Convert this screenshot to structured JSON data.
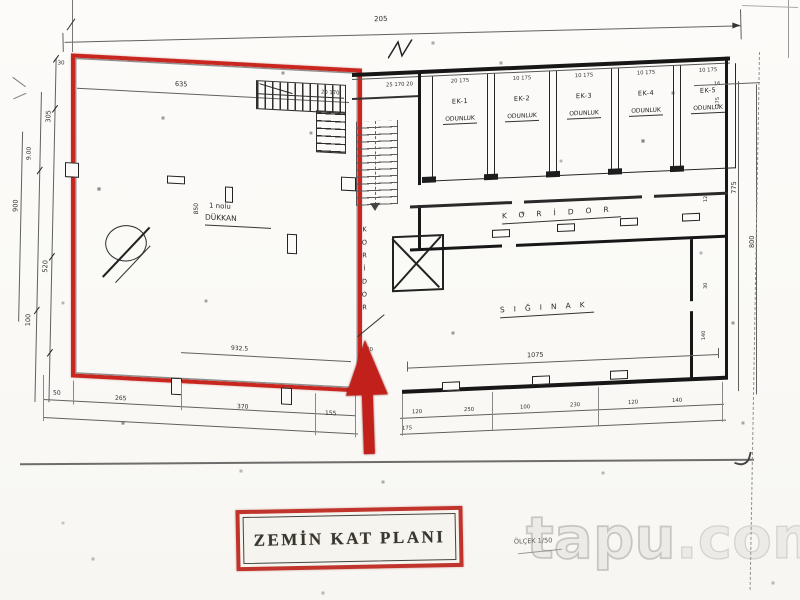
{
  "title_block": {
    "title": "ZEMİN KAT PLANI"
  },
  "scale": {
    "label": "ÖLÇEK 1/50"
  },
  "watermark": {
    "brand": "tapu",
    "suffix": ".com"
  },
  "rooms": {
    "shop": {
      "line1": "1 nolu",
      "line2": "DÜKKAN"
    },
    "corridor_vertical": "KORİDOR",
    "corridor_main": "KORİDOR",
    "shelter": "SIĞINAK",
    "storage_units": [
      {
        "id": "EK-1",
        "type": "ODUNLUK",
        "dims": "20  175"
      },
      {
        "id": "EK-2",
        "type": "ODUNLUK",
        "dims": "10  175"
      },
      {
        "id": "EK-3",
        "type": "ODUNLUK",
        "dims": "10  175"
      },
      {
        "id": "EK-4",
        "type": "ODUNLUK",
        "dims": "10  175"
      },
      {
        "id": "EK-5",
        "type": "ODUNLUK",
        "dims": "10  175"
      }
    ]
  },
  "dimensions": {
    "top_total": "205",
    "shop_inner_width": "635",
    "shop_height": "850",
    "shop_bottom_inner": "932.5",
    "shelter_width": "1075",
    "bottom_row": [
      "50",
      "265",
      "370",
      "155"
    ],
    "left_col": {
      "d30": "30",
      "d305": "305",
      "d900": "900",
      "d9_00": "9.00",
      "d520": "520",
      "d100": "100"
    },
    "right_col": {
      "d775": "775",
      "d800": "800",
      "d175": "175",
      "d125": "125",
      "d30": "30",
      "d140": "140"
    },
    "lower_right_row": [
      "120",
      "250",
      "100",
      "230",
      "120",
      "140"
    ],
    "stair_top": "25  170  20",
    "stair_top_left": "20  170",
    "cell_end": "16",
    "door_width": "70",
    "door_extra": "175"
  }
}
